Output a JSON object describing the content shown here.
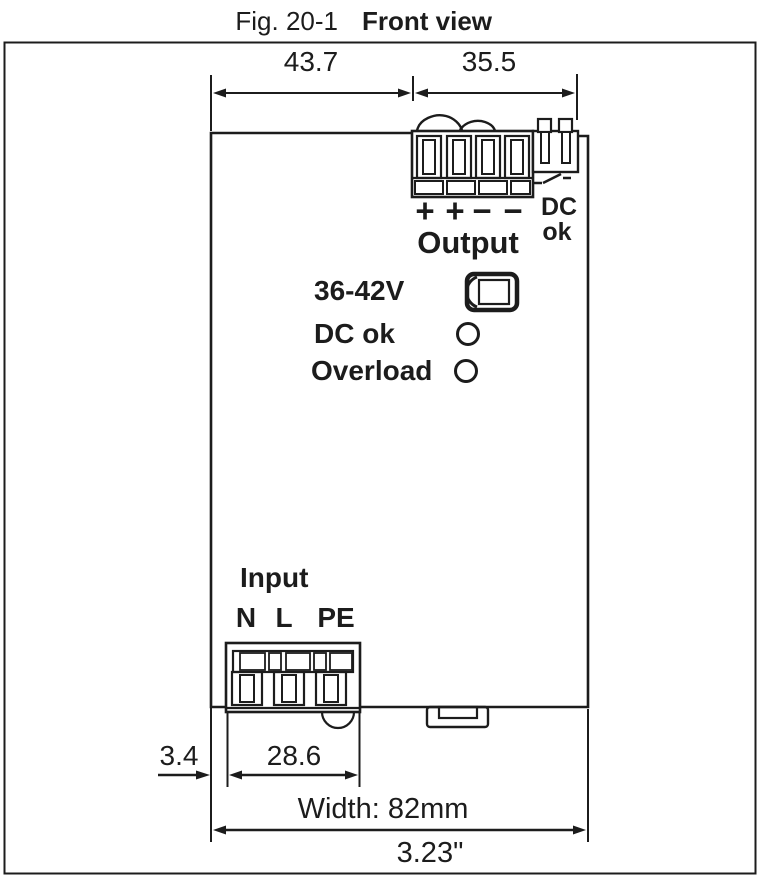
{
  "figure": {
    "label": "Fig. 20-1",
    "title": "Front view"
  },
  "dimensions": {
    "top_left_mm": "43.7",
    "top_right_mm": "35.5",
    "bottom_offset_mm": "3.4",
    "input_block_mm": "28.6",
    "overall_width": "Width: 82mm",
    "overall_width_inches": "3.23\""
  },
  "output_section": {
    "label": "Output",
    "terminals": [
      "+",
      "+",
      "−",
      "−"
    ],
    "dc_ok_contact": [
      "DC",
      "ok"
    ]
  },
  "front_panel": {
    "voltage_range": "36-42V",
    "dc_ok_led": "DC ok",
    "overload_led": "Overload"
  },
  "input_section": {
    "label": "Input",
    "terminals": [
      "N",
      "L",
      "PE"
    ]
  },
  "colors": {
    "ink": "#1c1c1c",
    "background": "#ffffff"
  }
}
